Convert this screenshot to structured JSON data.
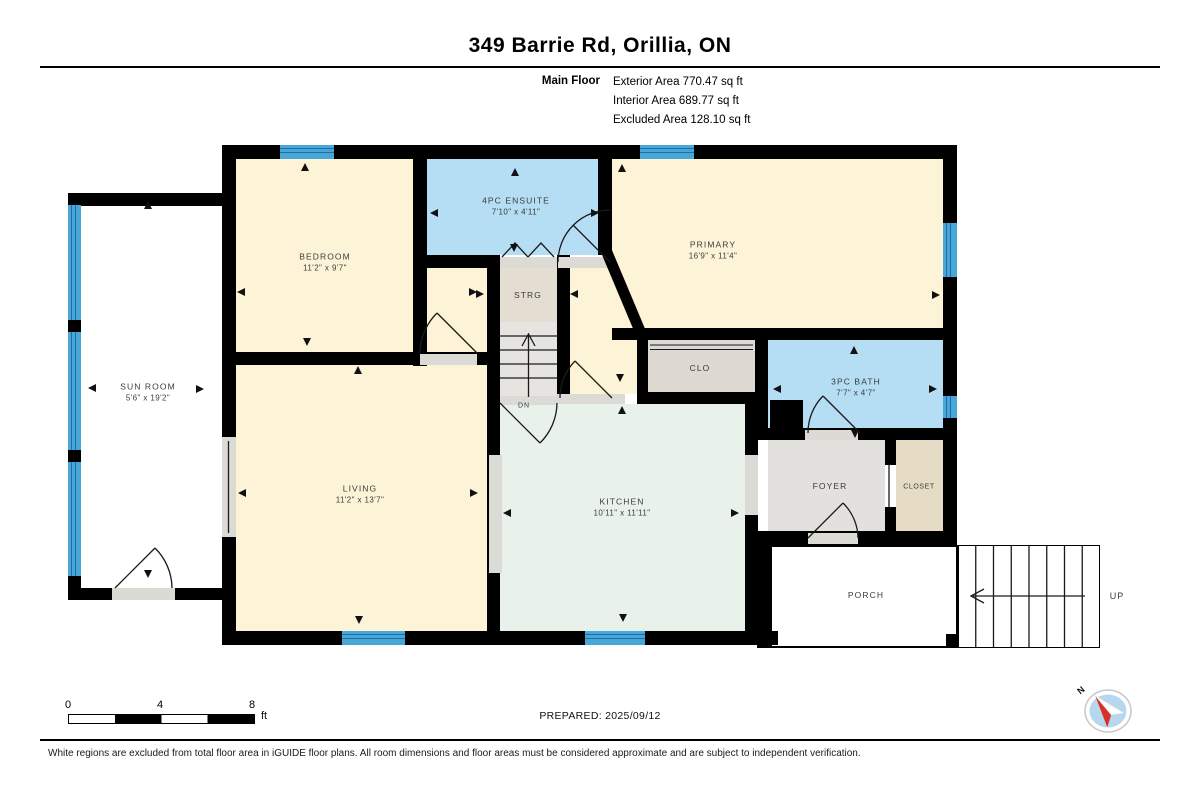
{
  "header": {
    "title": "349 Barrie Rd, Orillia, ON",
    "floor_label": "Main Floor",
    "area_lines": [
      "Exterior Area 770.47 sq ft",
      "Interior Area 689.77 sq ft",
      "Excluded Area 128.10 sq ft"
    ]
  },
  "rooms": {
    "bedroom": {
      "name": "BEDROOM",
      "dims": "11'2\" x 9'7\""
    },
    "ensuite": {
      "name": "4PC ENSUITE",
      "dims": "7'10\" x 4'11\""
    },
    "primary": {
      "name": "PRIMARY",
      "dims": "16'9\" x 11'4\""
    },
    "sunroom": {
      "name": "SUN ROOM",
      "dims": "5'6\" x 19'2\""
    },
    "living": {
      "name": "LIVING",
      "dims": "11'2\" x 13'7\""
    },
    "kitchen": {
      "name": "KITCHEN",
      "dims": "10'11\" x 11'11\""
    },
    "bath": {
      "name": "3PC BATH",
      "dims": "7'7\" x 4'7\""
    },
    "strg": {
      "name": "STRG"
    },
    "clo": {
      "name": "CLO"
    },
    "foyer": {
      "name": "FOYER"
    },
    "closet": {
      "name": "CLOSET"
    },
    "porch": {
      "name": "PORCH"
    }
  },
  "stairs": {
    "dn_label": "DN",
    "up_label": "UP"
  },
  "scale_bar": {
    "ticks": [
      "0",
      "4",
      "8"
    ],
    "unit": "ft"
  },
  "compass": {
    "north_label": "N"
  },
  "footer": {
    "prepared": "PREPARED: 2025/09/12",
    "disclaimer": "White regions are excluded from total floor area in iGUIDE floor plans. All room dimensions and floor areas must be considered approximate and are subject to independent verification."
  },
  "colors": {
    "room_beige": "#fdf3d7",
    "room_blue": "#b5ddf4",
    "room_mint": "#e9f2ea",
    "room_gray": "#e3e1dd",
    "closet_tan": "#e6dcc5",
    "window_blue": "#49a7d8",
    "wall": "#000000"
  }
}
